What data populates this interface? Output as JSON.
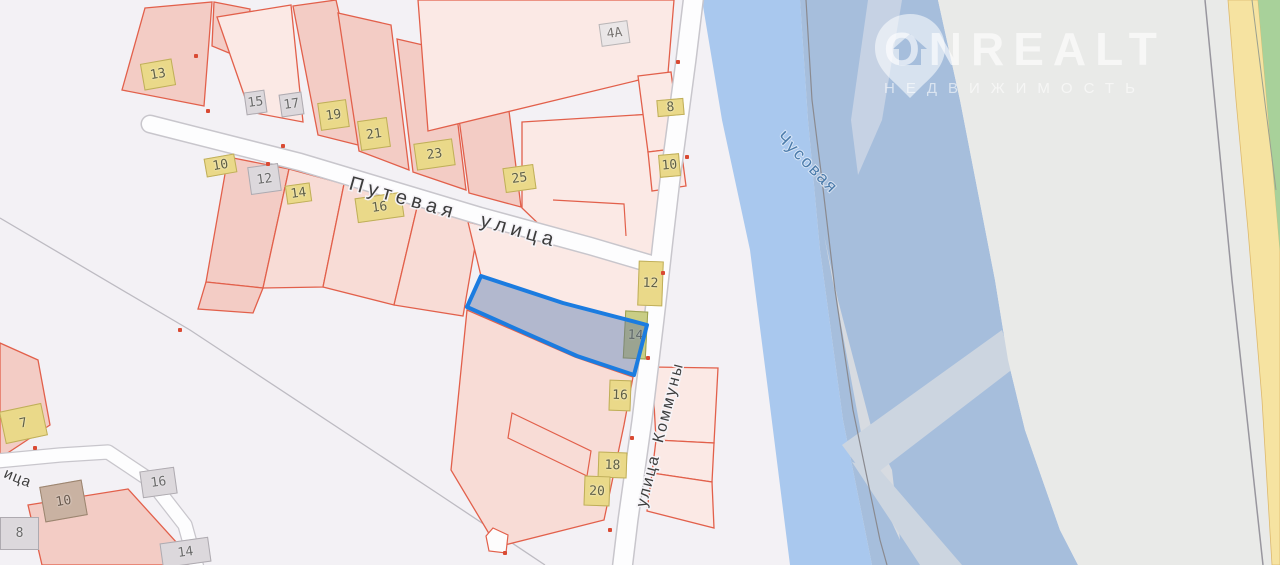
{
  "watermark": {
    "brand": "ONREALT",
    "tagline": "НЕДВИЖИМОСТЬ"
  },
  "map": {
    "streets": {
      "putevaya": "Путевая улица",
      "kommuny": "улица Коммуны",
      "partial_left": "ица"
    },
    "river": {
      "name": "Чусовая"
    },
    "selection": {
      "outline_color": "#1b7ce0",
      "fill_color": "rgba(100,115,160,0.45)"
    },
    "palette": {
      "parcel_stroke": "#e2604b",
      "parcel_fill": "#f8dcd6",
      "water": "#a9c8ee",
      "water_shaded": "#a6bedc",
      "island": "#e9eae8",
      "highway": "#f6e3a1",
      "vegetation": "#a8d19a"
    },
    "buildings": [
      {
        "label": "13",
        "type": "yellow",
        "x": 142,
        "y": 61,
        "w": 32,
        "h": 27,
        "rot": -10
      },
      {
        "label": "15",
        "type": "gray",
        "x": 245,
        "y": 91,
        "w": 21,
        "h": 23,
        "rot": -8
      },
      {
        "label": "17",
        "type": "gray",
        "x": 280,
        "y": 93,
        "w": 23,
        "h": 23,
        "rot": -8
      },
      {
        "label": "19",
        "type": "yellow",
        "x": 319,
        "y": 101,
        "w": 29,
        "h": 28,
        "rot": -8
      },
      {
        "label": "21",
        "type": "yellow",
        "x": 359,
        "y": 119,
        "w": 30,
        "h": 30,
        "rot": -8
      },
      {
        "label": "23",
        "type": "yellow",
        "x": 415,
        "y": 141,
        "w": 39,
        "h": 27,
        "rot": -8
      },
      {
        "label": "25",
        "type": "yellow",
        "x": 504,
        "y": 166,
        "w": 31,
        "h": 25,
        "rot": -8
      },
      {
        "label": "4A",
        "type": "white",
        "x": 600,
        "y": 22,
        "w": 29,
        "h": 23,
        "rot": -8
      },
      {
        "label": "8",
        "type": "yellow",
        "x": 657,
        "y": 99,
        "w": 27,
        "h": 17,
        "rot": -5
      },
      {
        "label": "10",
        "type": "yellow",
        "x": 659,
        "y": 154,
        "w": 21,
        "h": 23,
        "rot": -5
      },
      {
        "label": "10",
        "type": "yellow",
        "x": 205,
        "y": 156,
        "w": 31,
        "h": 19,
        "rot": -10
      },
      {
        "label": "12",
        "type": "gray",
        "x": 249,
        "y": 165,
        "w": 31,
        "h": 28,
        "rot": -8
      },
      {
        "label": "14",
        "type": "yellow",
        "x": 286,
        "y": 184,
        "w": 25,
        "h": 19,
        "rot": -8
      },
      {
        "label": "16",
        "type": "yellow",
        "x": 356,
        "y": 195,
        "w": 47,
        "h": 25,
        "rot": -8
      },
      {
        "label": "12",
        "type": "yellow",
        "x": 638,
        "y": 261,
        "w": 25,
        "h": 45,
        "rot": 2
      },
      {
        "label": "14",
        "type": "olive",
        "x": 624,
        "y": 311,
        "w": 23,
        "h": 48,
        "rot": 3
      },
      {
        "label": "16",
        "type": "yellow",
        "x": 609,
        "y": 380,
        "w": 22,
        "h": 31,
        "rot": 2
      },
      {
        "label": "18",
        "type": "yellow",
        "x": 598,
        "y": 452,
        "w": 29,
        "h": 26,
        "rot": 2
      },
      {
        "label": "20",
        "type": "yellow",
        "x": 584,
        "y": 476,
        "w": 26,
        "h": 30,
        "rot": 2
      },
      {
        "label": "7",
        "type": "yellow",
        "x": 2,
        "y": 407,
        "w": 43,
        "h": 33,
        "rot": -12
      },
      {
        "label": "10",
        "type": "brown",
        "x": 42,
        "y": 483,
        "w": 43,
        "h": 36,
        "rot": -10
      },
      {
        "label": "8",
        "type": "gray",
        "x": 0,
        "y": 517,
        "w": 39,
        "h": 33,
        "rot": 0
      },
      {
        "label": "16",
        "type": "gray",
        "x": 141,
        "y": 469,
        "w": 35,
        "h": 27,
        "rot": -8
      },
      {
        "label": "14",
        "type": "gray",
        "x": 161,
        "y": 540,
        "w": 49,
        "h": 25,
        "rot": -8
      }
    ],
    "corner_dots": [
      [
        196,
        56
      ],
      [
        208,
        111
      ],
      [
        268,
        164
      ],
      [
        283,
        146
      ],
      [
        678,
        62
      ],
      [
        687,
        157
      ],
      [
        663,
        273
      ],
      [
        550,
        240
      ],
      [
        648,
        358
      ],
      [
        632,
        438
      ],
      [
        610,
        530
      ],
      [
        35,
        448
      ],
      [
        505,
        553
      ],
      [
        180,
        330
      ]
    ]
  }
}
